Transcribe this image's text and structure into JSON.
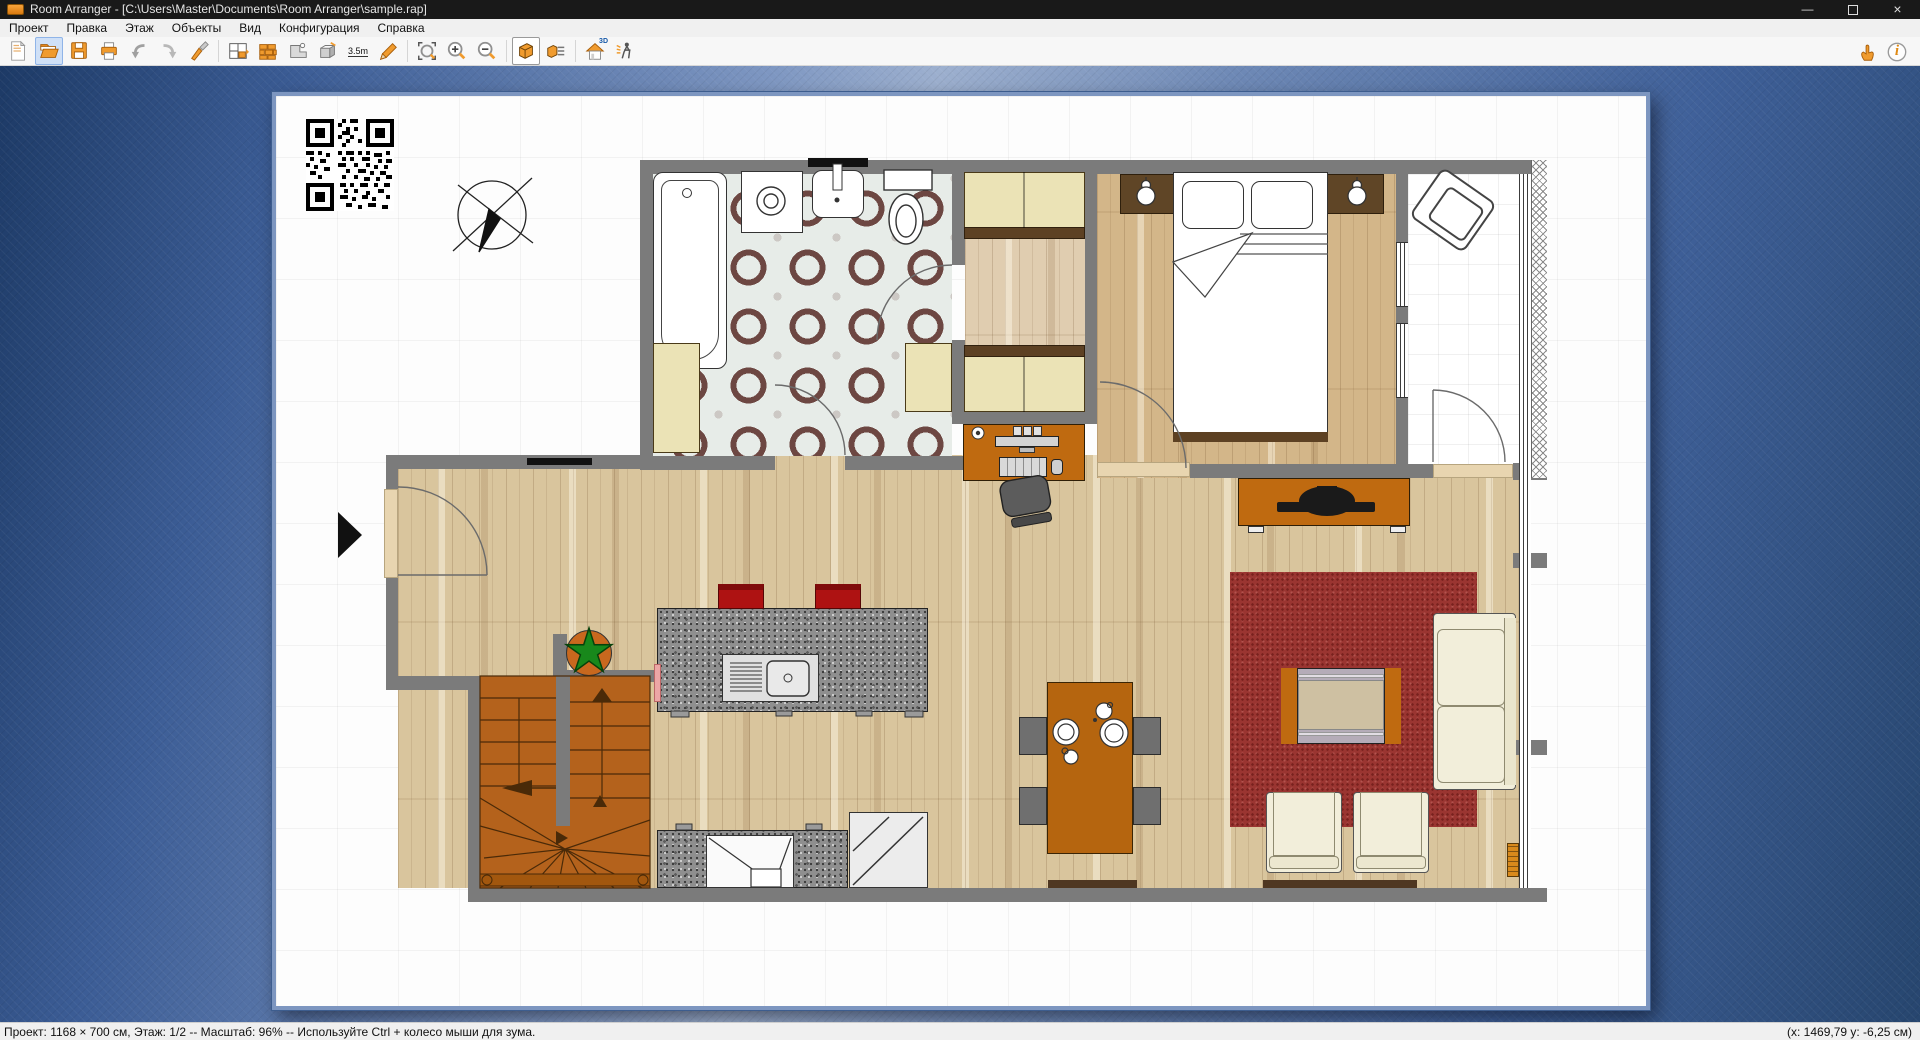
{
  "window": {
    "title": "Room Arranger - [C:\\Users\\Master\\Documents\\Room Arranger\\sample.rap]",
    "minimize_glyph": "—",
    "close_glyph": "×"
  },
  "menu": {
    "items": [
      "Проект",
      "Правка",
      "Этаж",
      "Объекты",
      "Вид",
      "Конфигурация",
      "Справка"
    ]
  },
  "toolbar": {
    "measure_label": "3.5m",
    "house3d_label": "3D",
    "info_label": "i",
    "icons": [
      "new",
      "open",
      "save",
      "print",
      "undo",
      "redo",
      "paint",
      "plan-editor",
      "bricks",
      "wall-tool",
      "object-3d",
      "measure",
      "pencil",
      "zoom-region",
      "zoom-in",
      "zoom-out",
      "view-3d",
      "view-3d-list",
      "house-3d",
      "walkthrough",
      "pointer-hand",
      "info"
    ],
    "active_icon": "view-3d",
    "highlighted_icon": "open"
  },
  "statusbar": {
    "left": "Проект: 1168 × 700 см, Этаж: 1/2 -- Масштаб: 96% -- Используйте Ctrl + колесо мыши для зума.",
    "right": "(x: 1469,79 y: -6,25 см)"
  },
  "plan": {
    "rooms": [
      "bathroom",
      "closet-corridor",
      "bedroom",
      "balcony",
      "living-room",
      "kitchen",
      "stairs"
    ],
    "zoom_percent": 96,
    "floor": "1/2"
  },
  "colors": {
    "accent_orange": "#e8861a",
    "wall_gray": "#7b7b7b",
    "carpet_red": "#9a3531",
    "wood_floor": "#d9c59d",
    "stairs_brown": "#b4621c",
    "canvas_blue": "#4a6ba3",
    "selection_blue": "#cfe0f7",
    "titlebar_black": "#191919"
  }
}
